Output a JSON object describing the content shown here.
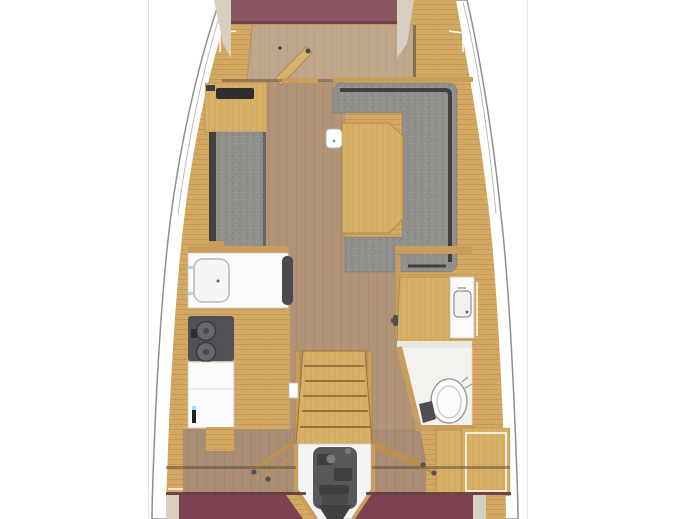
{
  "image": {
    "kind": "sailboat-interior-deck-plan",
    "view": "top-down",
    "width_px": 692,
    "height_px": 519
  },
  "floorplan": {
    "areas": [
      {
        "id": "forward-cabin",
        "features": [
          "double-berth-maroon",
          "pillow-panels",
          "open-door",
          "cabin-floor"
        ]
      },
      {
        "id": "salon",
        "features": [
          "port-cabinet-with-vent-slot",
          "port-settee-gray",
          "u-shaped-dinette-gray",
          "folding-table",
          "white-box-on-table-edge"
        ]
      },
      {
        "id": "galley-port",
        "features": [
          "white-counter-with-sink",
          "two-burner-stove",
          "refrigerator-counter",
          "handle-with-blue-tip"
        ]
      },
      {
        "id": "head-starboard",
        "features": [
          "wood-door",
          "vanity-with-sink",
          "toilet",
          "foot-pump"
        ]
      },
      {
        "id": "companionway",
        "features": [
          "wood-stairs-six-steps",
          "side-rails",
          "open-aft-cabin-doors"
        ]
      },
      {
        "id": "engine-compartment",
        "features": [
          "engine-block-gray",
          "white-bay-tapering-aft"
        ]
      },
      {
        "id": "aft-cabin-port",
        "features": [
          "berth-maroon",
          "pillow-cream"
        ]
      },
      {
        "id": "aft-cabin-starboard",
        "features": [
          "berth-maroon",
          "pillow-cream"
        ]
      },
      {
        "id": "hull",
        "features": [
          "outline-curve",
          "toe-rail-line",
          "side-decks-teak"
        ]
      }
    ]
  },
  "colors": {
    "background": "#ffffff",
    "panel_border": "#e4e4e4",
    "hull_outline": "#8f8f8f",
    "toe_rail": "#b5b5b5",
    "deck_wood": "#d3a963",
    "deck_wood_stripe": "#c2954f",
    "panel_wood": "#c99d5b",
    "wood_trim_dark": "#6b5a3e",
    "floor": "#b29478",
    "floor_fwd": "#c0a78b",
    "floor_aft": "#a98d74",
    "bed_fwd": "#8a5662",
    "bed_seam": "#6e414d",
    "bed_aft": "#7d4251",
    "pillow": "#d8cfc0",
    "upholstery": "#908f8b",
    "upholstery_light": "#9d9c98",
    "upholstery_shadow": "#817f7b",
    "uph_trim": "#3a3a3a",
    "table_wood": "#d8b169",
    "table_stripe": "#c79b52",
    "counter_white": "#fbfbfb",
    "counter_outline": "#c9c9c9",
    "stove": "#515156",
    "burner": "#67676c",
    "engine": "#58585a",
    "engine_dark": "#3f3f41",
    "engine_bay": "#f4f4f3",
    "toilet": "#fcfcfc",
    "fixture_outline": "#9c9c9c",
    "accent_cyan": "#9adcf0",
    "slot_dark": "#2d2d2d",
    "handle_dark": "#4a4a4e"
  }
}
